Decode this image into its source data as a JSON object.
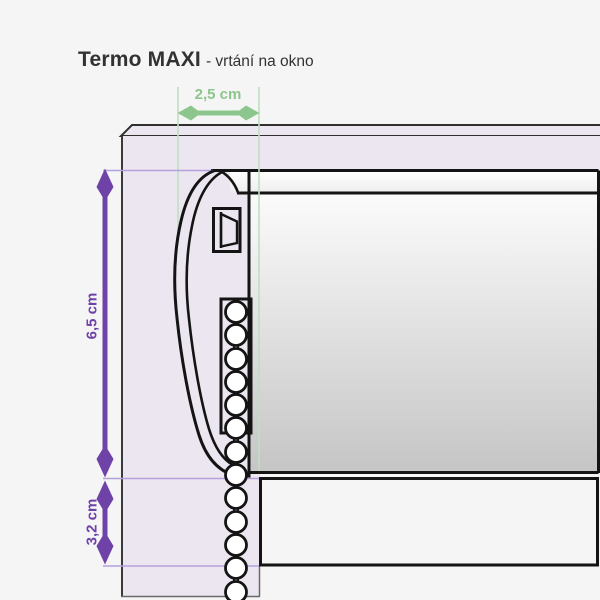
{
  "title": {
    "product": "Termo MAXI",
    "subtitle": "- vrtání na okno"
  },
  "dimensions": {
    "drill_width": {
      "label": "2,5 cm"
    },
    "bracket_height": {
      "label": "6,5 cm"
    },
    "drop_below_bracket": {
      "label": "3,2 cm"
    }
  },
  "colors": {
    "background": "#f5f5f5",
    "window_frame_fill": "#ece6f0",
    "blind_outline": "#141414",
    "dimension_purple": "#6f42a8",
    "extension_purple": "#b5a0dc",
    "dimension_green": "#8cc68c",
    "extension_green": "#bfe0bf",
    "tube_gradient_top": "#fbfbfb",
    "tube_gradient_bottom": "#c5c5c5",
    "chain_guard_fill": "#c7c7c7"
  }
}
